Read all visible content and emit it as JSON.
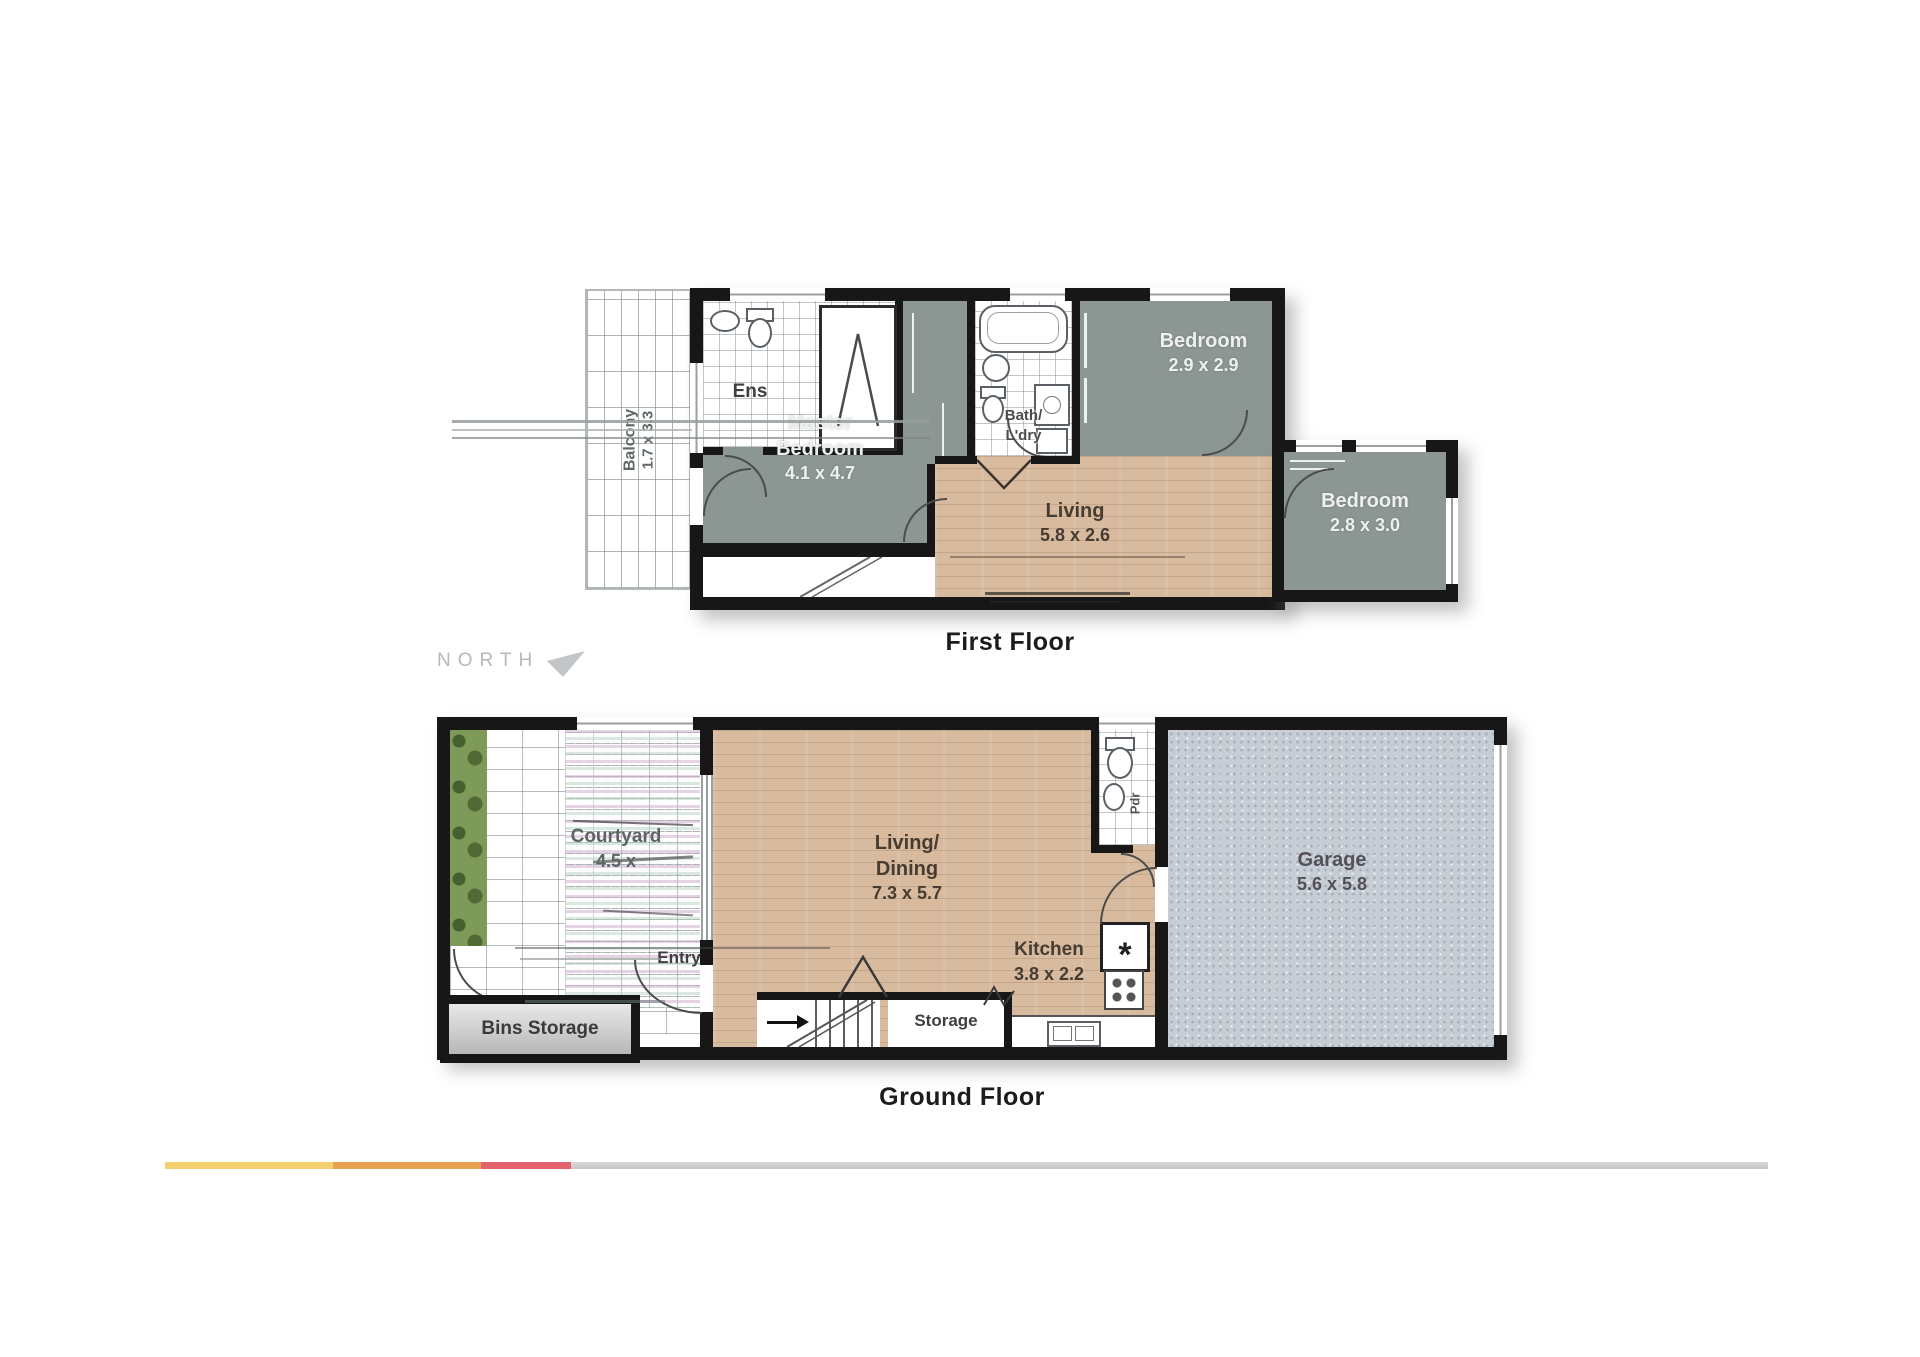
{
  "compass": {
    "label": "NORTH"
  },
  "floors": {
    "first": {
      "caption": "First Floor",
      "balcony": {
        "name": "Balcony",
        "size": "1.7 x 3.3"
      },
      "ens": {
        "name": "Ens"
      },
      "bath": {
        "line1": "Bath/",
        "line2": "L'dry"
      },
      "bedroom2": {
        "name": "Bedroom",
        "size": "2.9 x 2.9"
      },
      "bedroom3": {
        "name": "Bedroom",
        "size": "2.8 x 3.0"
      },
      "master": {
        "line1": "Master",
        "line2": "Bedroom",
        "size": "4.1 x 4.7"
      },
      "living": {
        "name": "Living",
        "size": "5.8 x 2.6"
      }
    },
    "ground": {
      "caption": "Ground Floor",
      "courtyard": {
        "name": "Courtyard",
        "size": "4.5 x"
      },
      "living_dining": {
        "line1": "Living/",
        "line2": "Dining",
        "size": "7.3 x 5.7"
      },
      "kitchen": {
        "name": "Kitchen",
        "size": "3.8 x 2.2"
      },
      "garage": {
        "name": "Garage",
        "size": "5.6 x 5.8"
      },
      "entry": {
        "name": "Entry"
      },
      "storage": {
        "name": "Storage"
      },
      "bins_storage": {
        "name": "Bins Storage"
      },
      "powder": {
        "name": "Pdr"
      },
      "pantry_symbol": "*"
    }
  },
  "colors": {
    "wall": "#171717",
    "bedroom_fill": "#8C9693",
    "wood_fill": "#D8BB9E",
    "garage_fill": "#C7CDD5",
    "garden_fill": "#7E9A58",
    "bar_yellow": "#F3CF6D",
    "bar_orange": "#E9A251",
    "bar_red": "#E2636C",
    "bar_gray": "#C6C6C6",
    "caption_text": "#1C1C1C",
    "label_light": "#EDF0EE",
    "label_dark": "#463C31",
    "north_text": "#B6B9BB"
  }
}
